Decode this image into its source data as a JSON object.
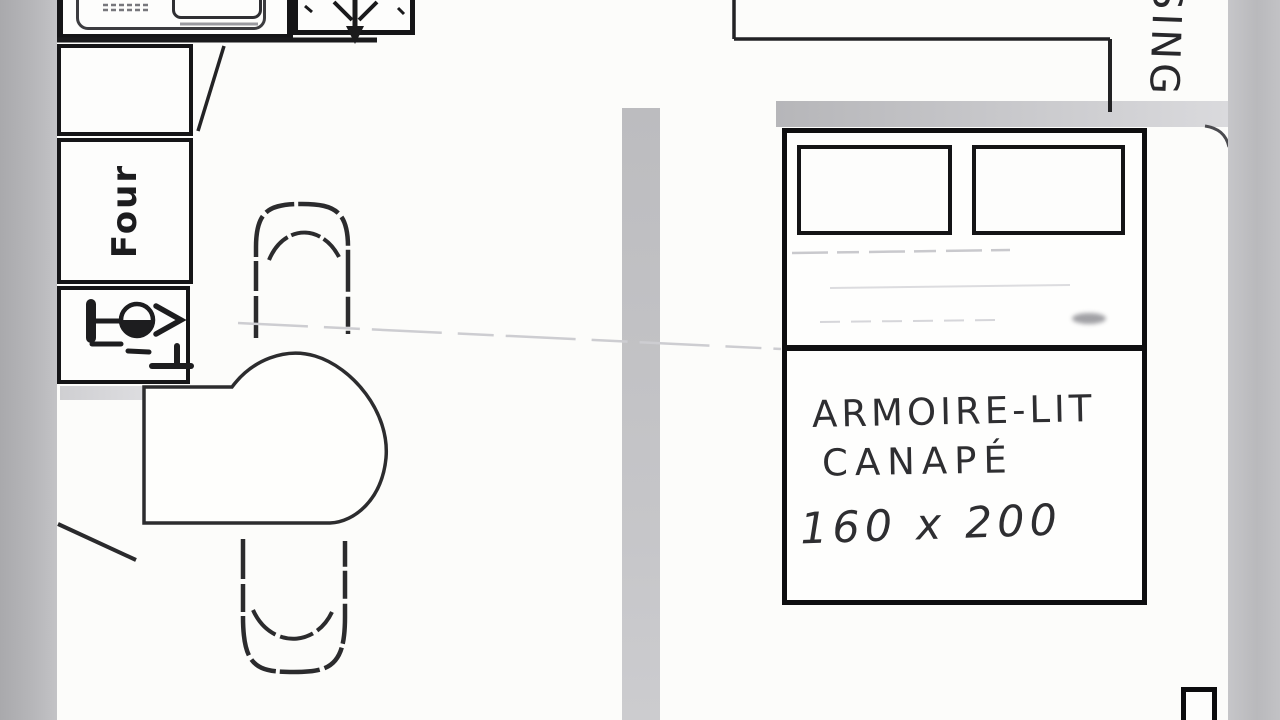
{
  "plan": {
    "title": "hand-drawn apartment floor plan (scan)",
    "kitchen": {
      "oven_label": "Four",
      "appliances": [
        "sink-basin-icon",
        "extractor-fan-icon",
        "fridge-box",
        "oven-box",
        "dishwasher-glass-icon"
      ],
      "furniture": [
        "dining-table",
        "chair-top",
        "chair-bottom"
      ]
    },
    "bedroom": {
      "bed_label_line1": "ARMOIRE-LIT",
      "bed_label_line2": "CANAPÉ",
      "bed_dimensions": "160 x 200",
      "corridor_label_partial": "SING",
      "furniture": [
        "murphy-bed",
        "pillow-left",
        "pillow-right"
      ]
    },
    "colors": {
      "paper": "#fcfcfa",
      "scan_margin_gray": "#b5b5b8",
      "ink_black": "#151517",
      "wall_gray": "#c2c2c5",
      "pencil_faint": "#cfcfd3",
      "handwriting": "#2e2e31"
    }
  }
}
